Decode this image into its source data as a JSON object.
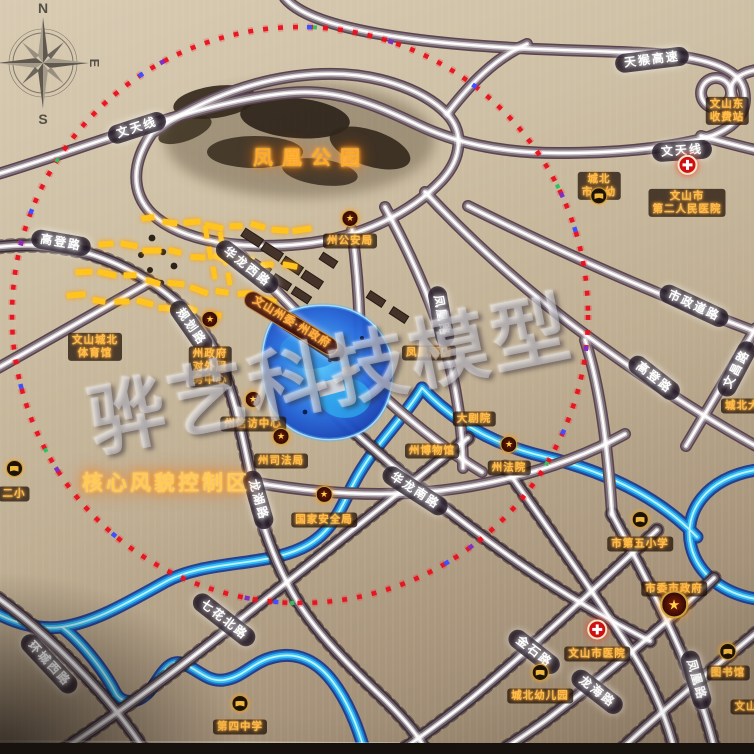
{
  "watermark": {
    "text": "骅艺科技模型"
  },
  "compass": {
    "n": "N",
    "e": "E",
    "s": "S"
  },
  "icons": {
    "star": "★"
  },
  "area_labels": {
    "park": {
      "text": "凤凰公园",
      "x": 311,
      "y": 156
    },
    "core_zone": {
      "text": "核心风貌控制区",
      "x": 166,
      "y": 482
    }
  },
  "road_labels": [
    {
      "text": "文天线",
      "x": 137,
      "y": 128,
      "rot": -18
    },
    {
      "text": "文天线",
      "x": 682,
      "y": 151,
      "rot": -4
    },
    {
      "text": "天猴高速",
      "x": 652,
      "y": 60,
      "rot": -7
    },
    {
      "text": "高登路",
      "x": 61,
      "y": 243,
      "rot": 10
    },
    {
      "text": "规划路",
      "x": 191,
      "y": 327,
      "rot": 55
    },
    {
      "text": "华龙西路",
      "x": 247,
      "y": 267,
      "rot": 38
    },
    {
      "text": "华龙北路",
      "x": 312,
      "y": 337,
      "rot": 33
    },
    {
      "text": "华龙南路",
      "x": 415,
      "y": 491,
      "rot": 33
    },
    {
      "text": "龙湖路",
      "x": 258,
      "y": 500,
      "rot": 74
    },
    {
      "text": "凤凰路",
      "x": 441,
      "y": 316,
      "rot": 80
    },
    {
      "text": "市政道路",
      "x": 694,
      "y": 306,
      "rot": 25
    },
    {
      "text": "高登路",
      "x": 654,
      "y": 378,
      "rot": 38
    },
    {
      "text": "文昌路",
      "x": 737,
      "y": 369,
      "rot": -62
    },
    {
      "text": "七花北路",
      "x": 224,
      "y": 620,
      "rot": 38
    },
    {
      "text": "环城西路",
      "x": 49,
      "y": 664,
      "rot": 47
    },
    {
      "text": "金石路",
      "x": 534,
      "y": 652,
      "rot": 38
    },
    {
      "text": "龙海路",
      "x": 597,
      "y": 692,
      "rot": 38
    },
    {
      "text": "凤凰路",
      "x": 696,
      "y": 680,
      "rot": 74
    }
  ],
  "poi_labels": [
    {
      "lines": [
        "州公安局"
      ],
      "icon": "star",
      "x": 350,
      "y": 241,
      "icon_dy": -15
    },
    {
      "lines": [
        "州政府",
        "对外服",
        "务中心"
      ],
      "icon": "star",
      "x": 210,
      "y": 367,
      "icon_dy": -27
    },
    {
      "lines": [
        "州信访中心"
      ],
      "icon": "star",
      "x": 253,
      "y": 424,
      "icon_dy": -17
    },
    {
      "lines": [
        "州司法局"
      ],
      "icon": "star",
      "x": 281,
      "y": 461,
      "icon_dy": -17
    },
    {
      "lines": [
        "国家安全局"
      ],
      "icon": "star",
      "x": 324,
      "y": 520,
      "icon_dy": -18
    },
    {
      "lines": [
        "州法院"
      ],
      "icon": "star",
      "x": 509,
      "y": 468,
      "icon_dy": -16
    },
    {
      "lines": [
        "市委市政府"
      ],
      "icon": "star-big",
      "x": 674,
      "y": 589,
      "icon_dy": 23
    },
    {
      "lines": [
        "文山州委·州政府"
      ],
      "style": "gov",
      "x": 291,
      "y": 323,
      "rot": 31
    },
    {
      "lines": [
        "文山城北",
        "体育馆"
      ],
      "x": 95,
      "y": 347
    },
    {
      "lines": [
        "凤凰酒店"
      ],
      "x": 429,
      "y": 353
    },
    {
      "lines": [
        "大剧院"
      ],
      "x": 474,
      "y": 419
    },
    {
      "lines": [
        "州博物馆"
      ],
      "x": 432,
      "y": 451
    },
    {
      "lines": [
        "市第五小学"
      ],
      "icon": "school",
      "x": 640,
      "y": 544,
      "icon_dy": -17
    },
    {
      "lines": [
        "图书馆"
      ],
      "icon": "school",
      "x": 728,
      "y": 673,
      "icon_dy": -14
    },
    {
      "lines": [
        "城北幼儿园"
      ],
      "icon": "school",
      "x": 540,
      "y": 696,
      "icon_dy": -16
    },
    {
      "lines": [
        "第四中学"
      ],
      "icon": "school",
      "x": 240,
      "y": 727,
      "icon_dy": -16
    },
    {
      "lines": [
        "城北",
        "市一幼"
      ],
      "icon": "school",
      "x": 599,
      "y": 186,
      "icon_dy": 24
    },
    {
      "lines": [
        "文山市医院"
      ],
      "icon": "hospital",
      "x": 597,
      "y": 654,
      "icon_dy": -17
    },
    {
      "lines": [
        "文山市",
        "第二人民医院"
      ],
      "icon": "hospital",
      "x": 687,
      "y": 203,
      "icon_dy": -24
    },
    {
      "lines": [
        "文山东",
        "收费站"
      ],
      "x": 727,
      "y": 111
    },
    {
      "lines": [
        "二小"
      ],
      "icon": "school",
      "x": 14,
      "y": 494,
      "icon_dy": -18
    },
    {
      "lines": [
        "城北大道"
      ],
      "x": 748,
      "y": 406
    },
    {
      "lines": [
        "文山"
      ],
      "x": 746,
      "y": 707
    }
  ]
}
